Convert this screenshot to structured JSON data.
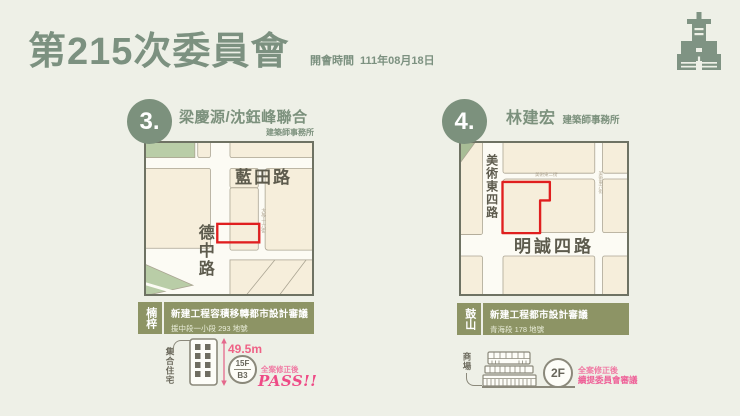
{
  "colors": {
    "background": "#eef0e7",
    "accent_green": "#7c9180",
    "tag_olive": "#8d9465",
    "site_outline_red": "#e01f1f",
    "result_pink": "#ee5f97",
    "map_block_cream": "#f6eedb",
    "map_block_green": "#b9cda7"
  },
  "header": {
    "title": "第215次委員會",
    "meeting_label": "開會時間",
    "meeting_date": "111年08月18日",
    "logo_icon": "tower-building-icon"
  },
  "cases": [
    {
      "number": "3.",
      "firm": "梁慶源/沈鈺峰聯合",
      "firm_suffix": "建築師事務所",
      "district": "楠梓",
      "review_title": "新建工程容積移轉都市設計審議",
      "site_lot": "援中段一小段 293 地號",
      "map": {
        "road_top": "藍田路",
        "road_left": "德中路",
        "lane_right": "大學十六街",
        "site_marker": "red-outline-rectangle"
      },
      "building_use": "集合住宅",
      "building_icon": "apartment-building-icon",
      "building_height": "49.5m",
      "floors_above": "15F",
      "floors_below": "B3",
      "result_note": "全案修正後",
      "result": "PASS!!"
    },
    {
      "number": "4.",
      "firm": "林建宏",
      "firm_suffix": "建築師事務所",
      "district": "鼓山",
      "review_title": "新建工程都市設計審議",
      "site_lot": "青海段 178 地號",
      "map": {
        "road_left": "美術東四路",
        "road_bottom": "明誠四路",
        "lane_top": "美術東二街",
        "lane_right": "美術東六街",
        "site_marker": "red-outline-polygon"
      },
      "building_use": "商場",
      "building_icon": "mall-building-icon",
      "floors_above": "2F",
      "result_note": "全案修正後",
      "result": "續提委員會審議"
    }
  ]
}
